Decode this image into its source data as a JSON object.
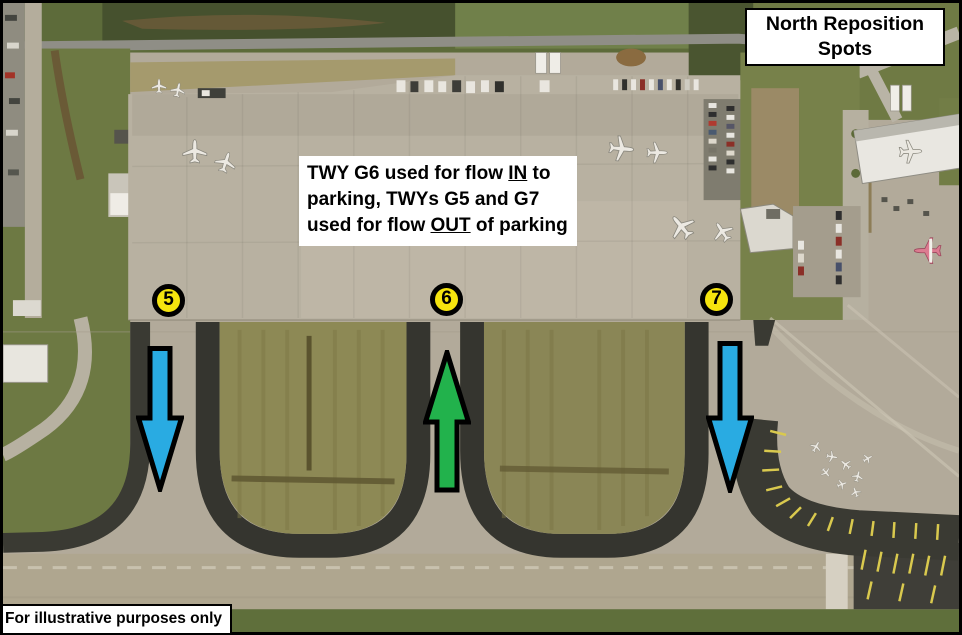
{
  "title": "North Reposition Spots",
  "note": {
    "l1a": "TWY G6 used for flow ",
    "l1b": "IN",
    "l1c": " to",
    "l2": "parking, TWYs G5 and G7",
    "l3a": "used for flow ",
    "l3b": "OUT",
    "l3c": " of parking"
  },
  "spots": [
    {
      "label": "5"
    },
    {
      "label": "6"
    },
    {
      "label": "7"
    }
  ],
  "arrows": [
    {
      "spot": "5",
      "direction": "down",
      "meaning": "flow out of parking"
    },
    {
      "spot": "6",
      "direction": "up",
      "meaning": "flow in to parking"
    },
    {
      "spot": "7",
      "direction": "down",
      "meaning": "flow out of parking"
    }
  ],
  "footer": "For illustrative purposes only",
  "colors": {
    "flow_out_arrow": "#29abe2",
    "flow_in_arrow": "#22b24c",
    "arrow_outline": "#000000",
    "spot_fill": "#f5e40e",
    "spot_ring": "#000000"
  }
}
